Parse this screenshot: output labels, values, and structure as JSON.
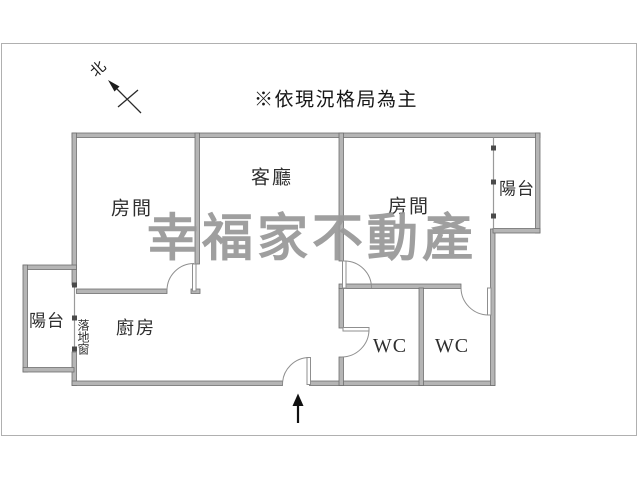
{
  "annotations": {
    "disclaimer": "※依現況格局為主",
    "watermark": "幸福家不動產",
    "compass_label": "北"
  },
  "rooms": {
    "living_room": {
      "label": "客廳"
    },
    "bedroom_left": {
      "label": "房間"
    },
    "bedroom_right": {
      "label": "房間"
    },
    "kitchen": {
      "label": "廚房"
    },
    "balcony_left": {
      "label": "陽台"
    },
    "balcony_right": {
      "label": "陽台"
    },
    "wc_left": {
      "label": "WC"
    },
    "wc_right": {
      "label": "WC"
    },
    "floor_window": {
      "label": "落地窗"
    }
  },
  "colors": {
    "wall_fill": "#b5b5b5",
    "wall_edge": "#6f6f6f",
    "thin_line": "#8f8f8f",
    "frame_border": "#b0b0b0",
    "text": "#2f2f2f",
    "watermark": "#9a9a9a",
    "arrow": "#111111"
  }
}
